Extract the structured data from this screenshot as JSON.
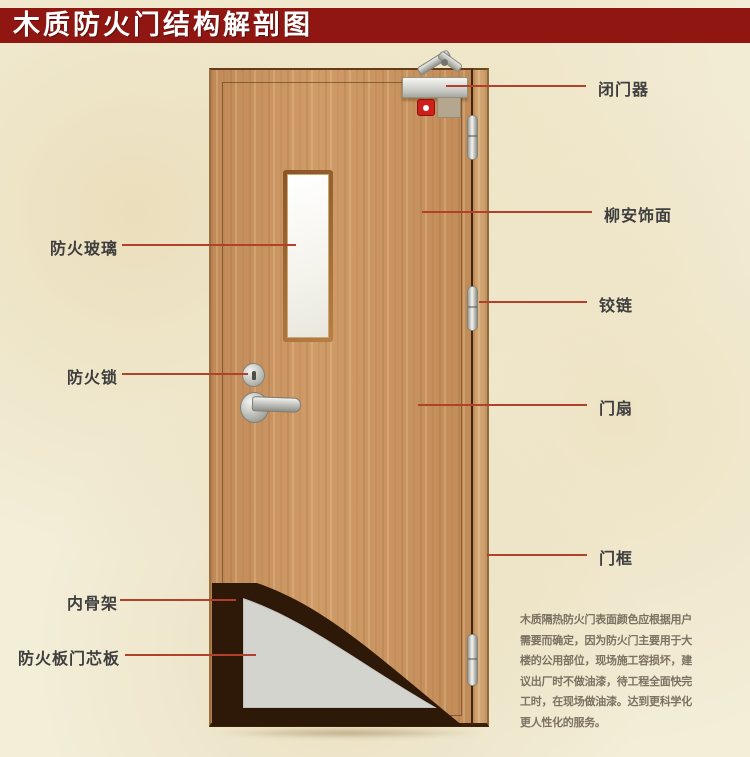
{
  "title": "木质防火门结构解剖图",
  "annotations": {
    "right": [
      {
        "label": "闭门器"
      },
      {
        "label": "柳安饰面"
      },
      {
        "label": "铰链"
      },
      {
        "label": "门扇"
      },
      {
        "label": "门框"
      }
    ],
    "left": [
      {
        "label": "防火玻璃"
      },
      {
        "label": "防火锁"
      },
      {
        "label": "内骨架"
      },
      {
        "label": "防火板门芯板"
      }
    ]
  },
  "description": "木质隔热防火门表面颜色应根据用户需要而确定，因为防火门主要用于大楼的公用部位，现场施工容损坏，建议出厂时不做油漆，待工程全面快完工时，在现场做油漆。达到更科学化更人性化的服务。",
  "colors": {
    "banner_red": "#8f1611",
    "leader_line_red": "#b2412c",
    "door_wood": "#ca9460",
    "frame_wood": "#d0a26e",
    "core_gray": "#d4d4cf",
    "cutaway_dark": "#2e1807",
    "paper_background": "#f3eed8",
    "label_text": "#3e3e3e",
    "description_text": "#7c7262"
  }
}
